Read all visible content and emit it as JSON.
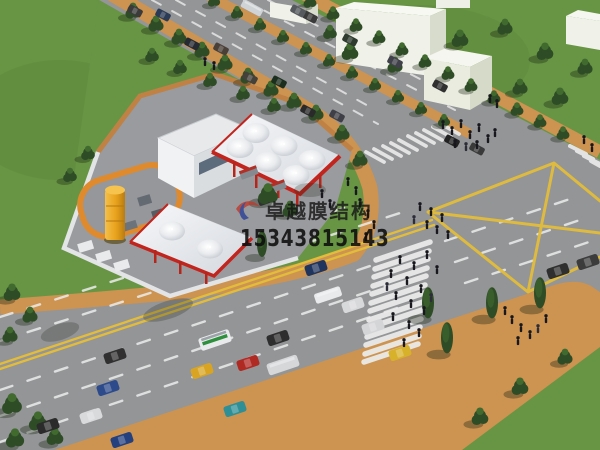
{
  "watermark": {
    "company_name": "卓越膜结构",
    "phone_number": "15343815143",
    "logo": "swoosh-logo",
    "logo_red": "#c03a2c",
    "logo_blue": "#2c3f96"
  },
  "scene": {
    "type": "3d-architectural-rendering",
    "subject": "aerial view of a membrane-structure gas station beside a large road intersection",
    "elements": [
      "gas-station-canopy",
      "small-canopy",
      "shop-building",
      "storage-tank",
      "tank-compound",
      "top-road",
      "bottom-road",
      "intersection",
      "yellow-junction-diamond",
      "crosswalks",
      "white-buildings",
      "trees",
      "vehicles",
      "pedestrians",
      "lawns",
      "orange-sidewalks",
      "perimeter-wall"
    ]
  },
  "colors": {
    "grass": "#679544",
    "grass_dark": "#557c34",
    "road": "#939597",
    "sidewalk": "#cd9350",
    "sidewalk_deep": "#c08144",
    "marking_white": "#ececec",
    "marking_yellow": "#e2bc3a",
    "trim_red": "#c2241e",
    "canopy": "#f1f2f5",
    "canopy_shade": "#c8ccd3",
    "building": "#f0f2ea",
    "building_side": "#d8dccd",
    "window": "#46586a",
    "lot": "#9a9b9e",
    "wall": "#e2e4e6",
    "tank": "#edaa24",
    "tree": "#2e4d26",
    "tree_light": "#416a2f",
    "ped": "#17171d"
  }
}
